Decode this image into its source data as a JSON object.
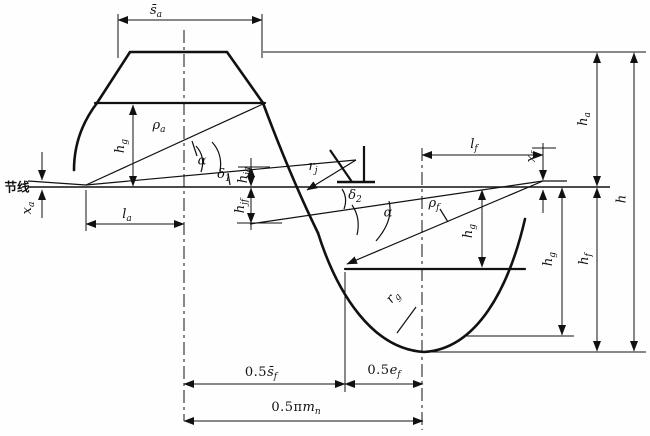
{
  "labels": {
    "jie_xian": {
      "base": "节线"
    },
    "s_a": {
      "base": "s̄",
      "sub": "a"
    },
    "x_a": {
      "base": "x",
      "sub": "a"
    },
    "l_a": {
      "base": "l",
      "sub": "a"
    },
    "h_g_left": {
      "base": "h",
      "sub": "g"
    },
    "rho_a": {
      "base": "ρ",
      "sub": "a"
    },
    "alpha_u": {
      "base": "α"
    },
    "delta_1": {
      "base": "δ",
      "sub": "1"
    },
    "h_ja": {
      "base": "h",
      "sub": "ja"
    },
    "h_jf": {
      "base": "h",
      "sub": "jf"
    },
    "r_j": {
      "base": "r",
      "sub": "j"
    },
    "delta_2": {
      "base": "δ",
      "sub": "2"
    },
    "alpha_l": {
      "base": "α"
    },
    "rho_f": {
      "base": "ρ",
      "sub": "f"
    },
    "h_g_inner": {
      "base": "h",
      "sub": "g"
    },
    "l_f": {
      "base": "l",
      "sub": "f"
    },
    "x_f": {
      "base": "x",
      "sub": "f"
    },
    "h_g_tall": {
      "base": "h",
      "sub": "g"
    },
    "h_f": {
      "base": "h",
      "sub": "f"
    },
    "h_a": {
      "base": "h",
      "sub": "a"
    },
    "h_full": {
      "base": "h"
    },
    "r_g": {
      "base": "r",
      "sub": "g"
    },
    "half_s_f": {
      "pre": "0.5",
      "base": "s̄",
      "sub": "f"
    },
    "half_e_f": {
      "pre": "0.5",
      "base": "e",
      "sub": "f"
    },
    "half_pi_mn": {
      "pre": "0.5π",
      "base": "m",
      "sub": "n"
    }
  },
  "colors": {
    "ink": "#111111",
    "paper": "#fefefe"
  }
}
